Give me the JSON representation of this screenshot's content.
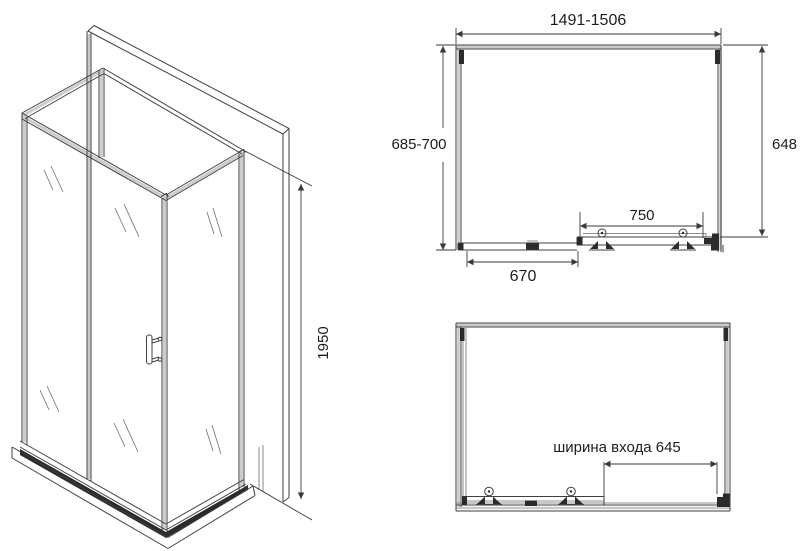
{
  "drawing": {
    "dimensions": {
      "plan_width_range": "1491-1506",
      "plan_depth_range": "685-700",
      "glass_wall_depth": "648",
      "sliding_door_width": "750",
      "fixed_panel_width": "670",
      "height": "1950",
      "entrance_width_label": "ширина входа 645"
    },
    "colors": {
      "line": "#3a3a3a",
      "band": "#c9c9c9",
      "dark_profile": "#2b2b2b",
      "text": "#1d1d1d",
      "background": "#ffffff"
    }
  }
}
